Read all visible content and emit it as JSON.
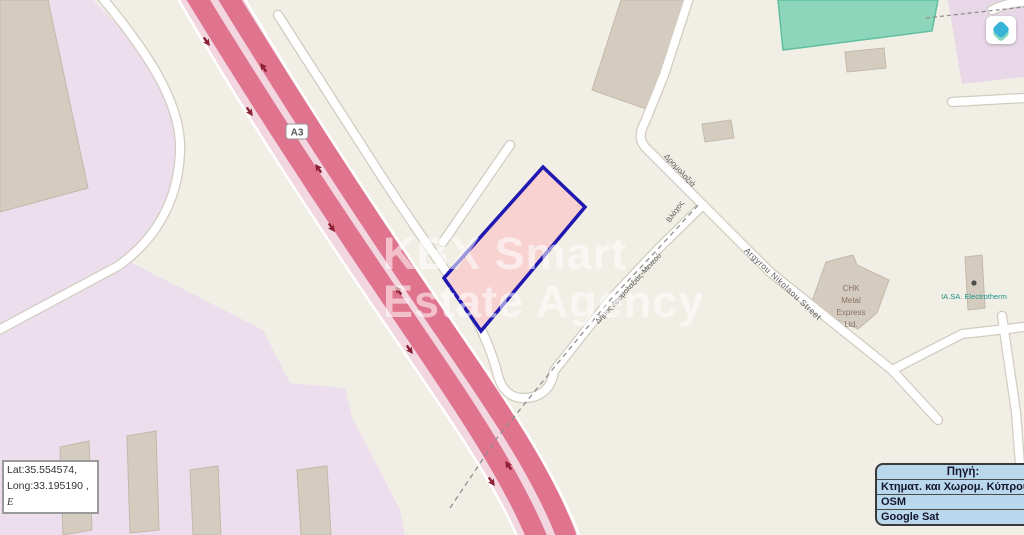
{
  "watermark": {
    "line1": "KBX Smart",
    "line2": "Estate Agency"
  },
  "coordinates": {
    "line1": "Lat:35.554574,",
    "line2": "Long:33.195190 ,",
    "line3": "E"
  },
  "source_panel": {
    "title": "Πηγή:",
    "options": [
      "Κτηματ. και Χωρομ. Κύπρου",
      "OSM",
      "Google Sat"
    ]
  },
  "roads": {
    "a3_badge": "A3",
    "dimos": "Δήμος Δρομολαξιάς-Μενεού",
    "dromolaxia": "Δρομολαξιά",
    "vlachos": "Βλάχος",
    "argyrou": "Argyrou Nikolaou Street"
  },
  "pois": {
    "chk_lines": [
      "CHK",
      "Metal",
      "Express",
      "Ltd."
    ],
    "electrotherm": "IA.SA. Electrotherm"
  },
  "icons": {
    "logo": "layers-diamond-icon",
    "poi_marker": "poi-marker-dot"
  },
  "colors": {
    "parcel_outline": "#2018b0",
    "parcel_fill": "#f7cfcf",
    "motorway_red": "#e0738d",
    "motorway_median": "#f2d7e0",
    "land_cream": "#f1eee5",
    "land_pink": "#ecdeec",
    "building_gray": "#d5ccc0",
    "green_building": "#8ed6bb",
    "panel_bg": "#b9d8ee",
    "logo_teal": "#38b3d8"
  }
}
